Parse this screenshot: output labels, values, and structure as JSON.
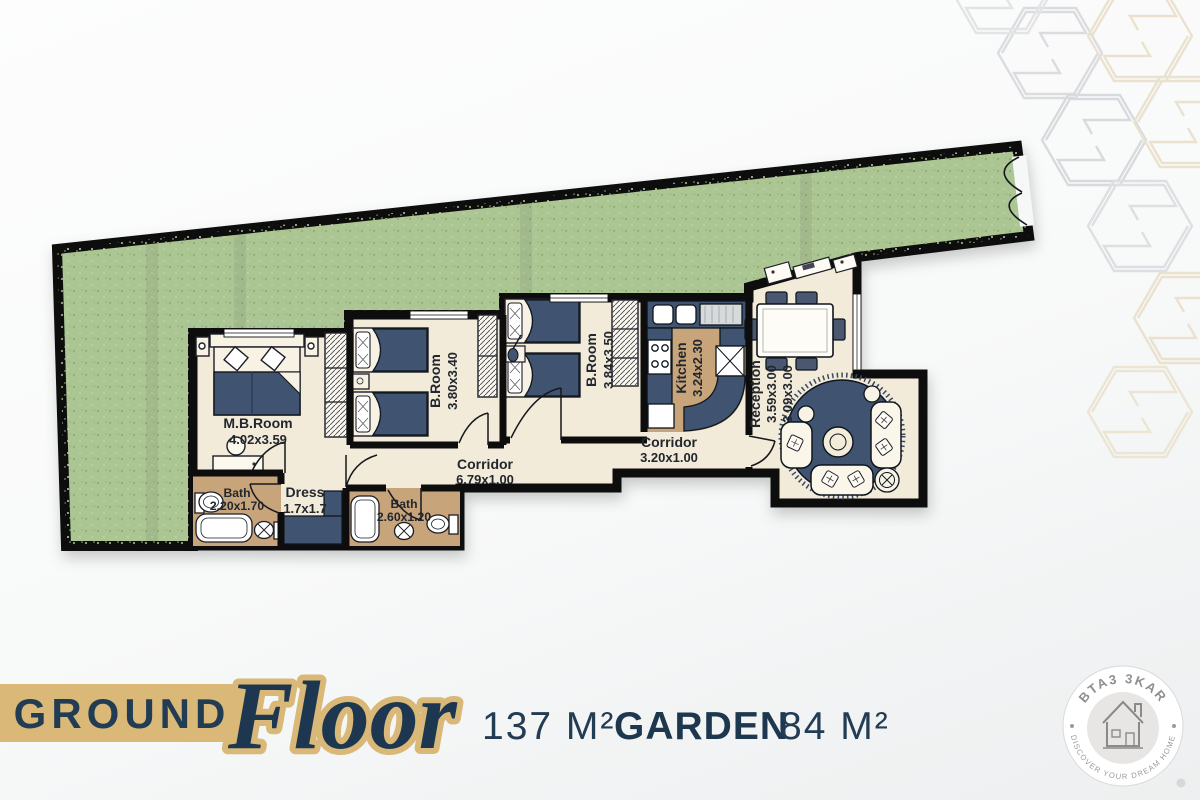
{
  "floor_plan": {
    "rooms": [
      {
        "id": "mb_room",
        "name": "M.B.Room",
        "dims": "4.02x3.59"
      },
      {
        "id": "b_room_1",
        "name": "B.Room",
        "dims": "3.80x3.40"
      },
      {
        "id": "b_room_2",
        "name": "B.Room",
        "dims": "3.84x3.50"
      },
      {
        "id": "kitchen",
        "name": "Kitchen",
        "dims": "3.24x2.30"
      },
      {
        "id": "reception",
        "name": "Reception",
        "dims": "3.59x3.00",
        "dims2": "3.09x3.00"
      },
      {
        "id": "corridor_main",
        "name": "Corridor",
        "dims": "6.79x1.00"
      },
      {
        "id": "corridor_2",
        "name": "Corridor",
        "dims": "3.20x1.00"
      },
      {
        "id": "bath_1",
        "name": "Bath",
        "dims": "2.20x1.70"
      },
      {
        "id": "dress",
        "name": "Dress",
        "dims": "1.7x1.7"
      },
      {
        "id": "bath_2",
        "name": "Bath",
        "dims": "2.60x1.20"
      }
    ]
  },
  "caption": {
    "floor_word": "GROUND",
    "floor_script": "Floor",
    "floor_area": "137 M²",
    "garden_word": "GARDEN",
    "garden_area": "84 M²"
  },
  "badge": {
    "brand": "BTA3 3KAR",
    "tagline": "DISCOVER YOUR DREAM HOME"
  },
  "icons": {
    "badge_center": "house-icon",
    "corner_pattern": "hexagon-s-motif"
  },
  "colors": {
    "garden_green": "#abc593",
    "wall_black": "#111111",
    "floor_cream": "#f2ebd9",
    "floor_tile_tan": "#c7a47a",
    "furniture_navy": "#41526f",
    "accent_gold": "#d9b878",
    "text_navy": "#1e3750",
    "badge_gray": "#8f8f8f"
  }
}
